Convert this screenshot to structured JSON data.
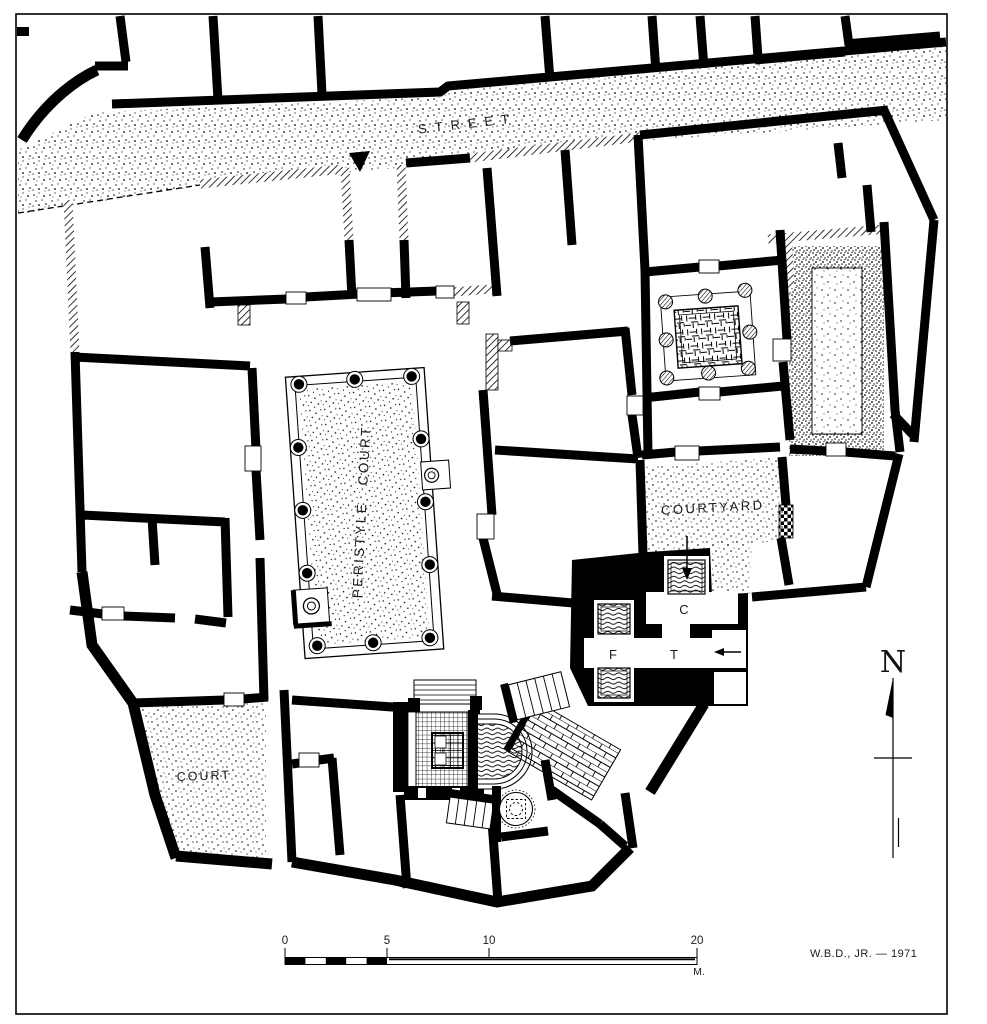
{
  "plan": {
    "title_context": "excavated house plan",
    "labels": {
      "street": "STREET",
      "peristyle_court": "PERISTYLE COURT",
      "courtyard": "COURTYARD",
      "court": "COURT",
      "room_c": "C",
      "room_f": "F",
      "room_t": "T"
    },
    "north_arrow": {
      "label": "N"
    },
    "scale_bar": {
      "tick_0": "0",
      "tick_5": "5",
      "tick_10": "10",
      "tick_20": "20",
      "unit": "M."
    },
    "signature": "W.B.D., JR. — 1971",
    "colors": {
      "ink": "#000000",
      "paper": "#ffffff"
    }
  }
}
